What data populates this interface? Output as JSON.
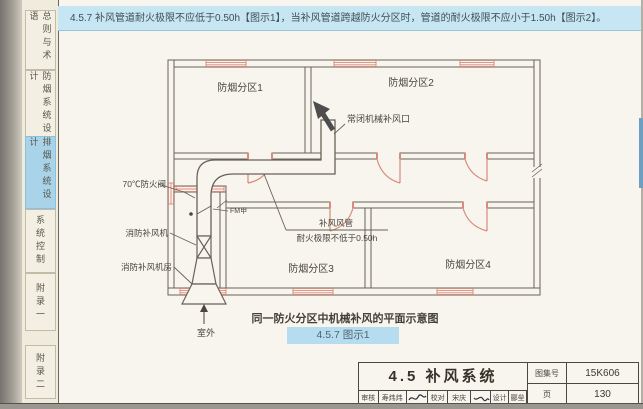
{
  "page": {
    "banner": "4.5.7  补风管道耐火极限不应低于0.50h【图示1】，当补风管道跨越防火分区时，管道的耐火极限不应小于1.50h【图示2】。",
    "caption": "同一防火分区中机械补风的平面示意图",
    "figure_tag": "4.5.7 图示1"
  },
  "sidebar": {
    "tabs": [
      {
        "label": "总则与术语",
        "active": false
      },
      {
        "label": "防烟系统设计",
        "active": false
      },
      {
        "label": "排烟系统设计",
        "active": true
      },
      {
        "label": "系统控制",
        "active": false
      },
      {
        "label": "附录一",
        "active": false
      },
      {
        "label": "附录二",
        "active": false
      }
    ]
  },
  "diagram": {
    "zone1": "防烟分区1",
    "zone2": "防烟分区2",
    "zone3": "防烟分区3",
    "zone4": "防烟分区4",
    "damper_label": "70℃防火阀",
    "damper_mark": "FM甲",
    "fan_label": "消防补风机",
    "fan_room_label": "消防补风机房",
    "duct_label_line1": "补风风管",
    "duct_label_line2": "耐火极限不低于0.50h",
    "outlet_label": "常闭机械补风口",
    "outdoor_label": "室外"
  },
  "titleblock": {
    "title": "4.5  补风系统",
    "atlas_label": "图集号",
    "atlas_no": "15K606",
    "page_label": "页",
    "page_no": "130",
    "review_label": "审核",
    "review_name": "寿炜炜",
    "proof_label": "校对",
    "proof_name": "宋庆",
    "design_label": "设计",
    "design_name": "郦垒"
  },
  "colors": {
    "banner_blue": "#c6e6f3",
    "tab_active_blue": "#a8d3e8",
    "figure_tag_blue": "#b5dcef",
    "drawing_red": "#d98a7a",
    "line_ink": "#6a6258",
    "page_cream": "#f7f5ee"
  }
}
